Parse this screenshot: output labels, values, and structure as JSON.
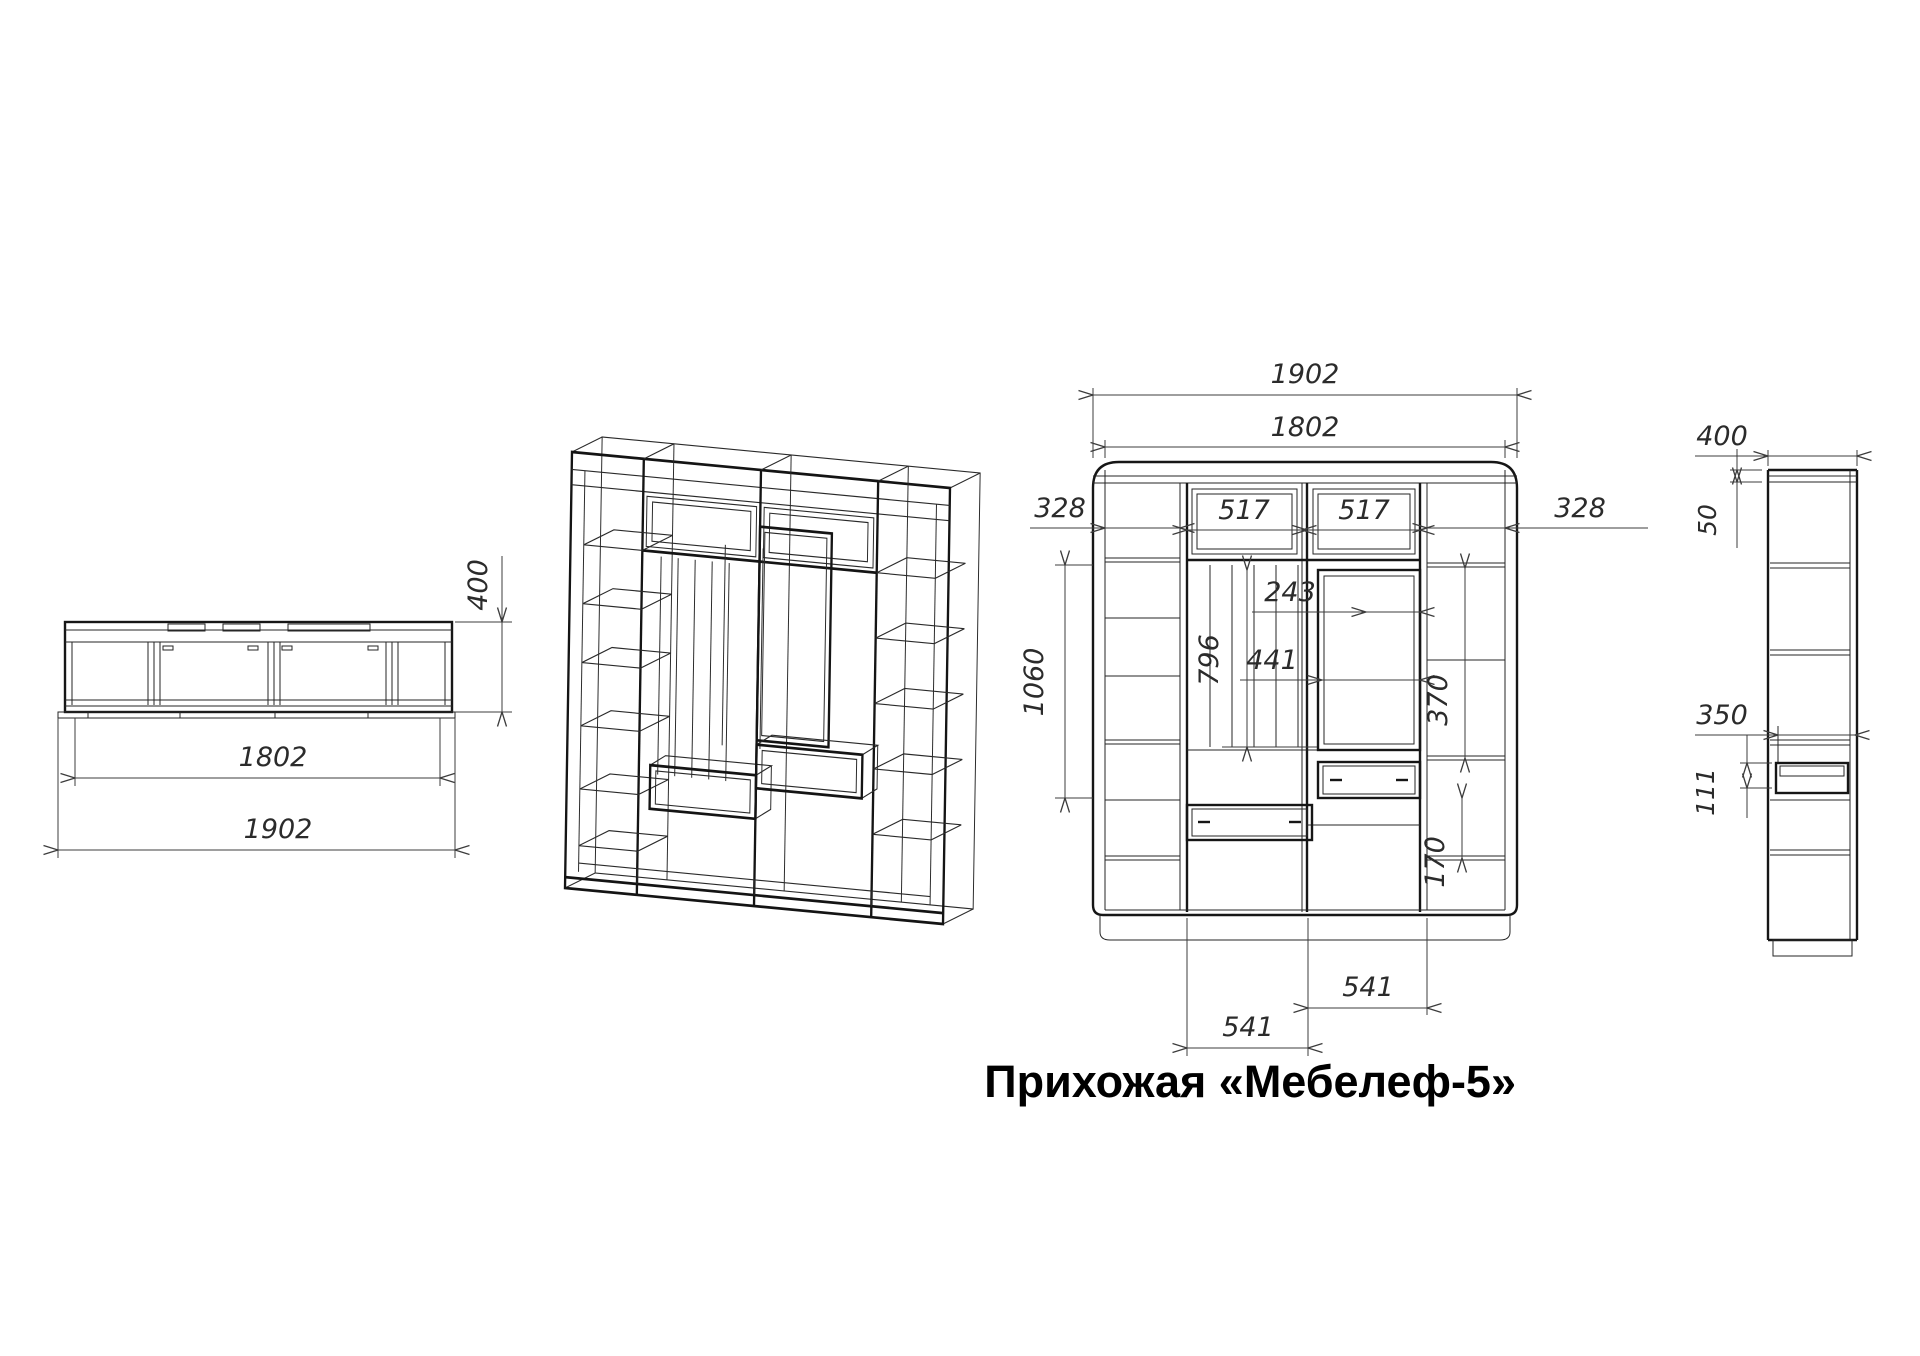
{
  "title": "Прихожая «Мебелеф-5»",
  "views": {
    "top": {
      "dim_inner_width": "1802",
      "dim_outer_width": "1902",
      "dim_depth": "400"
    },
    "front": {
      "dim_outer_width": "1902",
      "dim_body_width": "1802",
      "dim_left_section": "328",
      "dim_center_left": "517",
      "dim_center_right": "517",
      "dim_right_section": "328",
      "dim_left_height": "1060",
      "dim_mirror_height": "796",
      "dim_hook_gap": "243",
      "dim_mirror_width": "441",
      "dim_shelf_gap": "370",
      "dim_drawer_front": "170",
      "dim_drawer_left_width": "541",
      "dim_drawer_right_width": "541"
    },
    "side": {
      "dim_depth": "400",
      "dim_top_panel": "50",
      "dim_shelf_depth": "350",
      "dim_drawer_height": "111"
    }
  }
}
